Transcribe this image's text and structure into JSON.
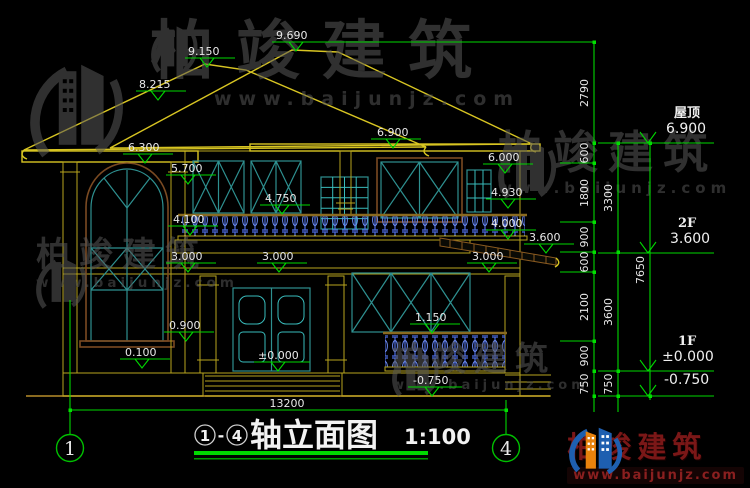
{
  "title": {
    "axis_start": "1",
    "axis_end": "4",
    "separator": "-",
    "name": "轴立面图",
    "scale": "1:100"
  },
  "axis_bubbles": {
    "left": "1",
    "right": "4"
  },
  "levels": {
    "roof": {
      "label": "屋顶",
      "value": "6.900"
    },
    "f2": {
      "label": "2F",
      "value": "3.600"
    },
    "f1": {
      "label": "1F",
      "value": "±0.000"
    },
    "ground": {
      "value": "-0.750"
    }
  },
  "elevations": {
    "peak": "9.690",
    "ridge_left": "9.150",
    "slope_left": "8.215",
    "eave": "6.900",
    "tower_cornice": "6.300",
    "band_2f": "5.700",
    "window_top_2f": "6.000",
    "corbel_2f": "4.930",
    "rail_top": "4.750",
    "tower_band": "4.100",
    "balcony_floor": "4.000",
    "porch_eave": "3.600",
    "cornice_1f_left": "3.000",
    "cornice_1f_mid": "3.000",
    "cornice_1f_right": "3.000",
    "porch_rail": "1.150",
    "sill_1f": "0.900",
    "plinth_top": "0.100",
    "floor_1f": "±0.000",
    "ground_mid": "-0.750"
  },
  "dimensions": {
    "col1": [
      "2790",
      "600",
      "1800",
      "900",
      "600",
      "2100",
      "900",
      "750"
    ],
    "col2": [
      "3300",
      "3600",
      "750"
    ],
    "total_height": "7650",
    "overall_width": "13200"
  },
  "watermark": {
    "brand": "柏竣建筑",
    "url": "www.baijunjz.com"
  },
  "footer_logo": {
    "brand": "柏竣建筑",
    "url": "www.baijunjz.com"
  },
  "colors": {
    "dim_green": "#00d800",
    "wall_yellow": "#b7a41e",
    "window_teal": "#2e9090",
    "baluster_blue": "#4e6ce0",
    "brand_red": "#7a1717"
  }
}
